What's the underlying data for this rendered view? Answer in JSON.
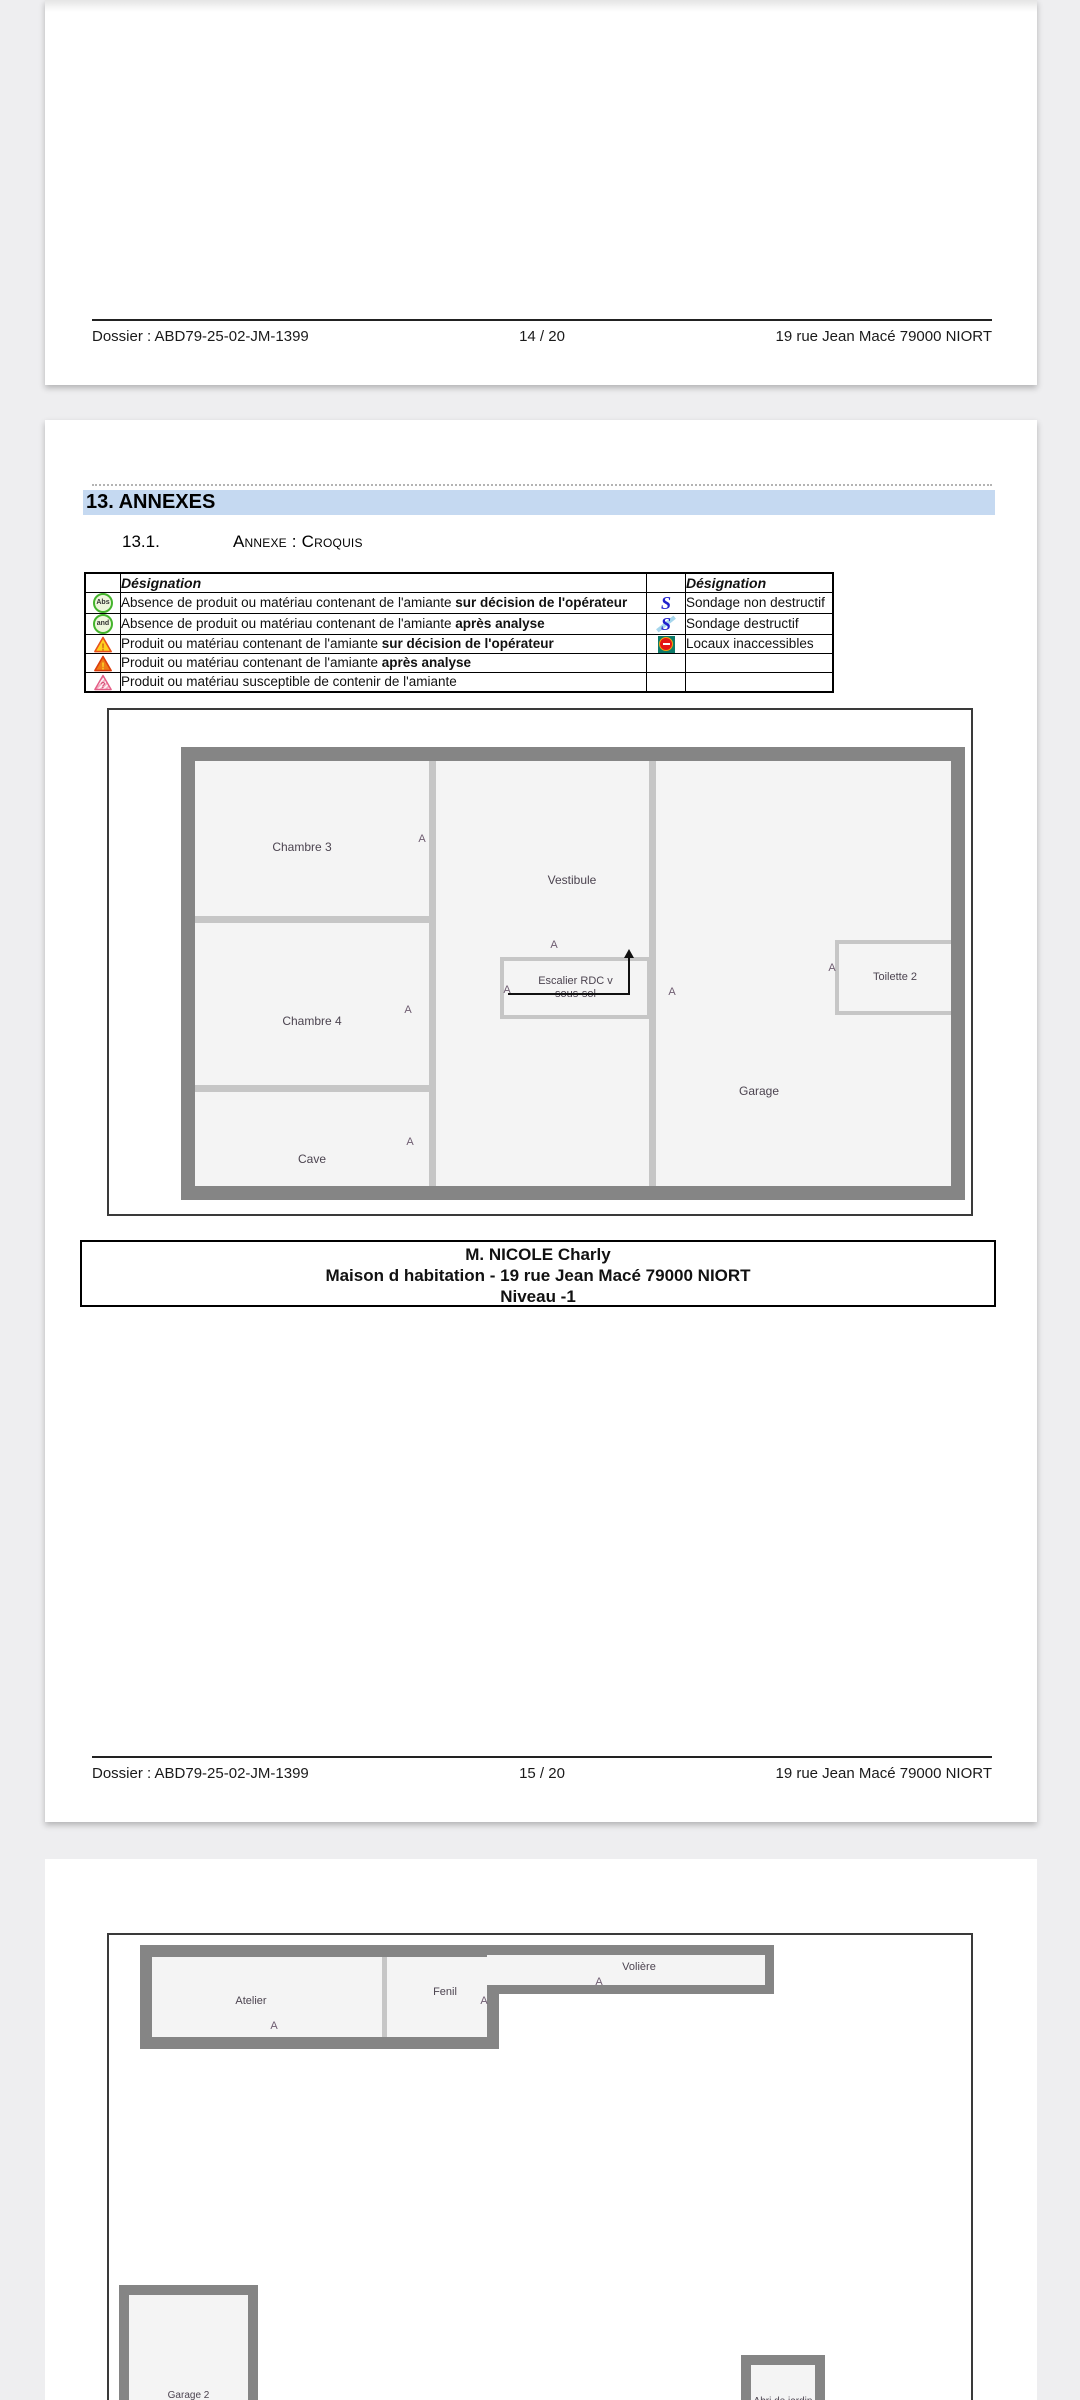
{
  "doc": {
    "footer1": {
      "dossier": "Dossier : ABD79-25-02-JM-1399",
      "page": "14 / 20",
      "address": "19 rue Jean Macé 79000 NIORT"
    },
    "footer2": {
      "dossier": "Dossier : ABD79-25-02-JM-1399",
      "page": "15 / 20",
      "address": "19 rue Jean Macé 79000 NIORT"
    }
  },
  "section": {
    "heading": "13. ANNEXES",
    "sub_num": "13.1.",
    "sub_title": "Annexe : Croquis"
  },
  "legend": {
    "header_left": "Désignation",
    "header_right": "Désignation",
    "sondage_glyph": "S",
    "rows": [
      {
        "icon": "abs-green-circle",
        "icon_label": "Abs",
        "text": "Absence de produit ou matériau contenant de l'amiante ",
        "bold": "sur décision de l'opérateur",
        "icon2": "sondage-non-destructif",
        "text2": "Sondage non destructif"
      },
      {
        "icon": "and-green-circle",
        "icon_label": "and",
        "text": "Absence de produit ou matériau contenant de l'amiante ",
        "bold": "après analyse",
        "icon2": "sondage-destructif",
        "text2": "Sondage destructif"
      },
      {
        "icon": "warning-triangle-outline",
        "icon_label": "!",
        "text": "Produit ou matériau contenant de l'amiante ",
        "bold": "sur décision de l'opérateur",
        "icon2": "locaux-inaccessibles",
        "text2": "Locaux inaccessibles"
      },
      {
        "icon": "warning-triangle-solid",
        "icon_label": "!",
        "text": "Produit ou matériau contenant de l'amiante ",
        "bold": "après analyse",
        "icon2": "",
        "text2": ""
      },
      {
        "icon": "warning-triangle-hatched",
        "icon_label": "?",
        "text": "Produit ou matériau susceptible de contenir de l'amiante",
        "bold": "",
        "icon2": "",
        "text2": ""
      }
    ]
  },
  "plan_niveau_minus1": {
    "marker": "A",
    "rooms": {
      "chambre3": "Chambre 3",
      "vestibule": "Vestibule",
      "chambre4": "Chambre 4",
      "cave": "Cave",
      "garage": "Garage",
      "toilette2": "Toilette 2",
      "escalier_l1": "Escalier RDC v",
      "escalier_l2": "sous-sol"
    }
  },
  "caption": {
    "line1": "M. NICOLE Charly",
    "line2": "Maison d habitation - 19 rue Jean Macé 79000 NIORT",
    "line3": "Niveau -1"
  },
  "plan_exterieur": {
    "marker": "A",
    "rooms": {
      "atelier": "Atelier",
      "fenil": "Fenil",
      "voliere": "Volière",
      "garage2": "Garage 2",
      "abri": "Abri de jardin"
    }
  },
  "colors": {
    "heading_bg": "#c5d9f1",
    "wall_gray": "#858585",
    "legend_green": "#44b42c",
    "legend_yellow": "#ffd21e",
    "legend_red_orange": "#e8521a",
    "sondage_blue": "#2121cd",
    "inaccessible_teal": "#0d7a69",
    "inaccessible_red": "#e41414"
  }
}
